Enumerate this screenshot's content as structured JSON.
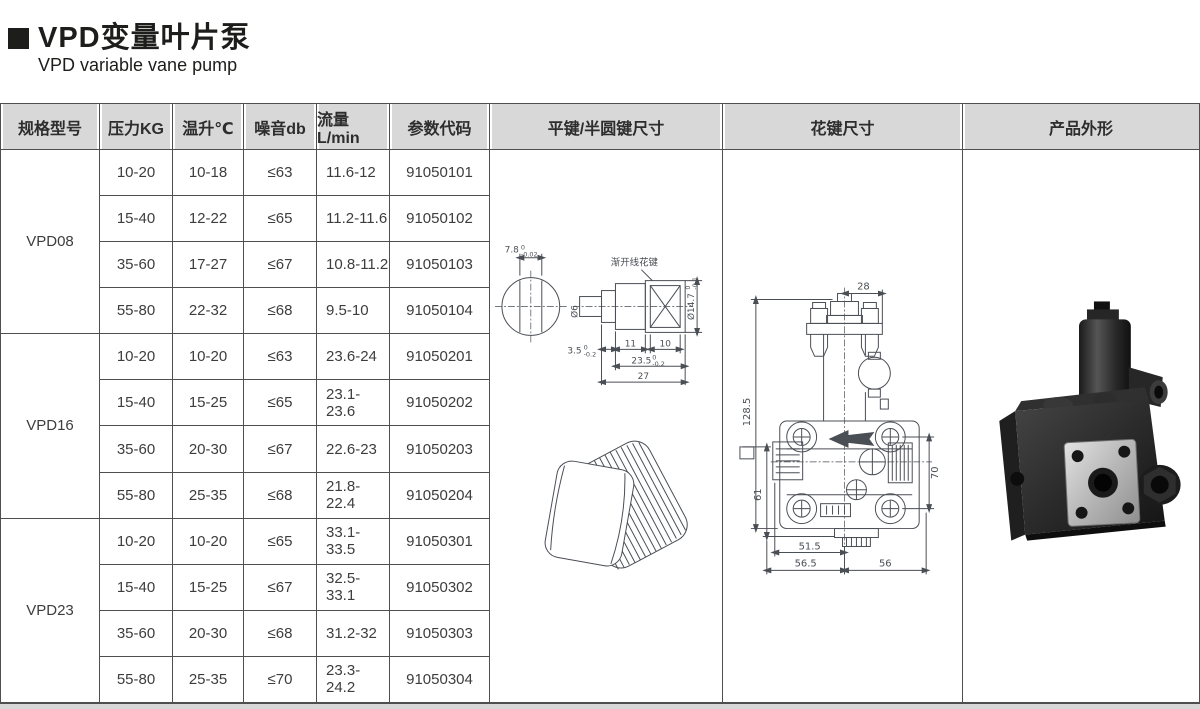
{
  "page": {
    "title": "VPD变量叶片泵",
    "subtitle": "VPD variable vane pump"
  },
  "table": {
    "headers": [
      "规格型号",
      "压力KG",
      "温升℃",
      "噪音db",
      "流量L/min",
      "参数代码",
      "平键/半圆键尺寸",
      "花键尺寸",
      "产品外形"
    ],
    "groups": [
      {
        "model": "VPD08",
        "rows": [
          {
            "pressure": "10-20",
            "temp": "10-18",
            "noise": "≤63",
            "flow": "11.6-12",
            "code": "91050101"
          },
          {
            "pressure": "15-40",
            "temp": "12-22",
            "noise": "≤65",
            "flow": "11.2-11.6",
            "code": "91050102"
          },
          {
            "pressure": "35-60",
            "temp": "17-27",
            "noise": "≤67",
            "flow": "10.8-11.2",
            "code": "91050103"
          },
          {
            "pressure": "55-80",
            "temp": "22-32",
            "noise": "≤68",
            "flow": "9.5-10",
            "code": "91050104"
          }
        ]
      },
      {
        "model": "VPD16",
        "rows": [
          {
            "pressure": "10-20",
            "temp": "10-20",
            "noise": "≤63",
            "flow": "23.6-24",
            "code": "91050201"
          },
          {
            "pressure": "15-40",
            "temp": "15-25",
            "noise": "≤65",
            "flow": "23.1-23.6",
            "code": "91050202"
          },
          {
            "pressure": "35-60",
            "temp": "20-30",
            "noise": "≤67",
            "flow": "22.6-23",
            "code": "91050203"
          },
          {
            "pressure": "55-80",
            "temp": "25-35",
            "noise": "≤68",
            "flow": "21.8-22.4",
            "code": "91050204"
          }
        ]
      },
      {
        "model": "VPD23",
        "rows": [
          {
            "pressure": "10-20",
            "temp": "10-20",
            "noise": "≤65",
            "flow": "33.1-33.5",
            "code": "91050301"
          },
          {
            "pressure": "15-40",
            "temp": "15-25",
            "noise": "≤67",
            "flow": "32.5-33.1",
            "code": "91050302"
          },
          {
            "pressure": "35-60",
            "temp": "20-30",
            "noise": "≤68",
            "flow": "31.2-32",
            "code": "91050303"
          },
          {
            "pressure": "55-80",
            "temp": "25-35",
            "noise": "≤70",
            "flow": "23.3-24.2",
            "code": "91050304"
          }
        ]
      }
    ]
  },
  "key_drawing": {
    "key_width": "7.8",
    "key_width_tol_top": "0",
    "key_width_tol_bot": "-0.02",
    "spline_label": "渐开线花键",
    "dia_small": "Ø6",
    "step": "3.5",
    "step_tol_top": "0",
    "step_tol_bot": "-0.2",
    "len_body": "11",
    "len_spline": "10",
    "len_mid": "23.5",
    "len_mid_tol_top": "0",
    "len_mid_tol_bot": "-0.2",
    "len_total": "27",
    "dia_spline": "Ø14.7",
    "dia_spline_tol_top": "0",
    "dia_spline_tol_bot": "-0.1"
  },
  "pump_drawing": {
    "w_top": "28",
    "h_total": "128.5",
    "h_left": "61",
    "h_right": "70",
    "w_bottom1": "51.5",
    "w_bottom2": "56.5",
    "w_bottom3": "56"
  },
  "colors": {
    "header_bg": "#d8d8d8",
    "border": "#4f4f4f",
    "text": "#3d3d3d",
    "drawing_stroke": "#4a4e55",
    "title": "#1d1d1b"
  }
}
